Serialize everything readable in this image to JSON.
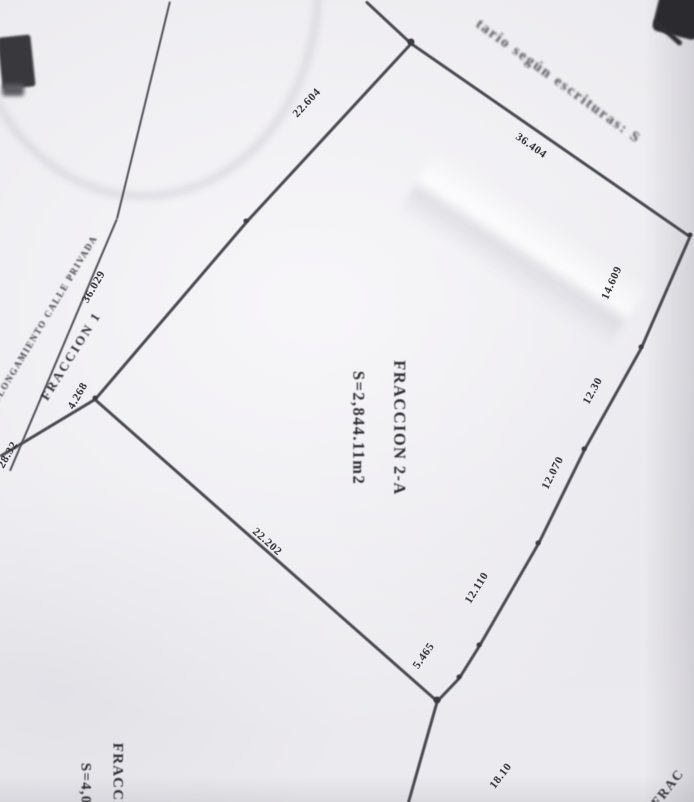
{
  "plan": {
    "annotation_top": "tario según escrituras: S",
    "street_label": "PROLONGAMIENTO CALLE PRIVADA",
    "fraction1_label": "FRACCION 1",
    "parcel_2a": {
      "name": "FRACCION 2-A",
      "area": "S=2,844.11m2"
    },
    "parcel_bottom": {
      "name": "FRACCION",
      "area": "S=4,00"
    },
    "corner_fragment": "FRAC",
    "measurements": {
      "top_left_edge": "22.604",
      "top_right_edge": "36.404",
      "right_seg_1": "14.609",
      "right_seg_2": "12.30",
      "right_seg_3": "12.070",
      "right_seg_4": "12.110",
      "right_seg_5": "5.465",
      "right_seg_6": "18.10",
      "bottom_edge": "22.202",
      "left_seg_1": "36.029",
      "left_seg_2": "4.268",
      "left_seg_3": "28.32"
    },
    "colors": {
      "paper": "#ebeaee",
      "ink": "#4a4a52",
      "text_ink": "#2f2f36"
    }
  }
}
